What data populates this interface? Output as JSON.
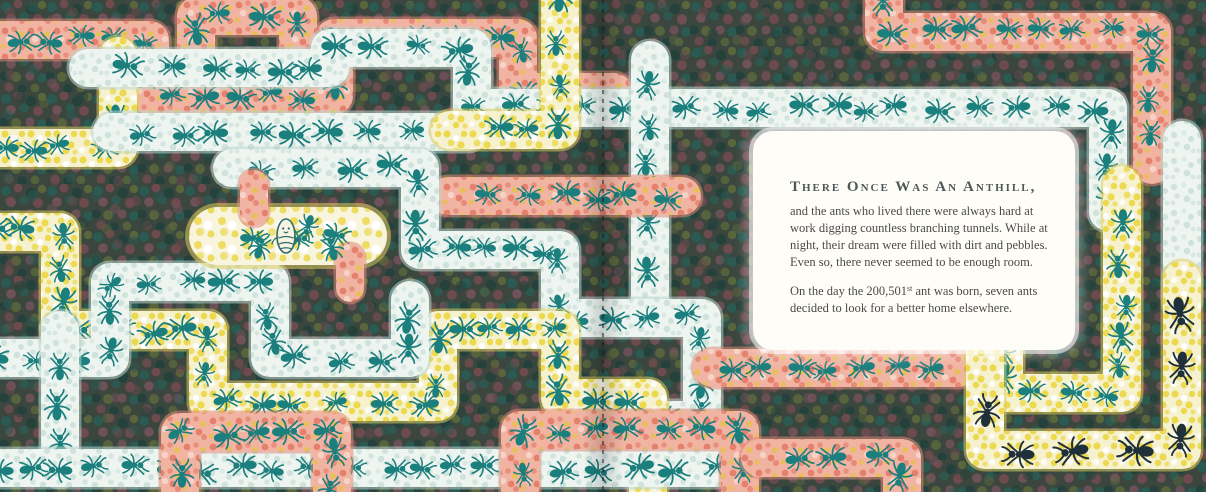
{
  "story": {
    "heading": "There Once Was An Anthill,",
    "paragraph1_lines": [
      "and the ants who lived there were always hard at",
      "work digging countless branching tunnels. While at",
      "night, their dream were filled with dirt and pebbles.",
      "Even so, there never seemed to be enough room."
    ],
    "paragraph2": {
      "lead": "On the day the 200,501",
      "superscript": "st",
      "after_sup": " ant was born, seven ants",
      "line2": "decided to look for a better home elsewhere."
    }
  },
  "palette": {
    "background_base": "#3a463e",
    "bg_dot_teal": "#2a5a52",
    "bg_dot_maroon": "#6c4a4d",
    "bg_dot_olive": "#59663c",
    "bg_dot_dark_teal": "#24413c",
    "bg_dot_plum": "#75525c",
    "tunnel_white": "#eef5f1",
    "tunnel_white_dot": "#cfe2dc",
    "tunnel_white_edge": "#b9d3cc",
    "tunnel_yellow": "#f6f1cf",
    "tunnel_yellow_dot": "#ecd94e",
    "tunnel_yellow_edge": "#dbca5e",
    "tunnel_chamber": "#f8f4dd",
    "tunnel_salmon": "#f1b4a3",
    "tunnel_salmon_dot": "#e5806c",
    "tunnel_salmon_edge": "#dd8a76",
    "tunnel_salmon_gold": "#e9bf59",
    "tunnel_salmon_light": "#f6d3c6",
    "ant_teal": "#1b7f7e",
    "ant_black": "#20303a",
    "panel_background": "#fffdf8",
    "heading_color": "#4e585a",
    "body_color": "#4a4a48",
    "fold_line_color": "#1c1c1c",
    "larva_body": "#f6f2e4",
    "larva_outline": "#2e6b64"
  }
}
